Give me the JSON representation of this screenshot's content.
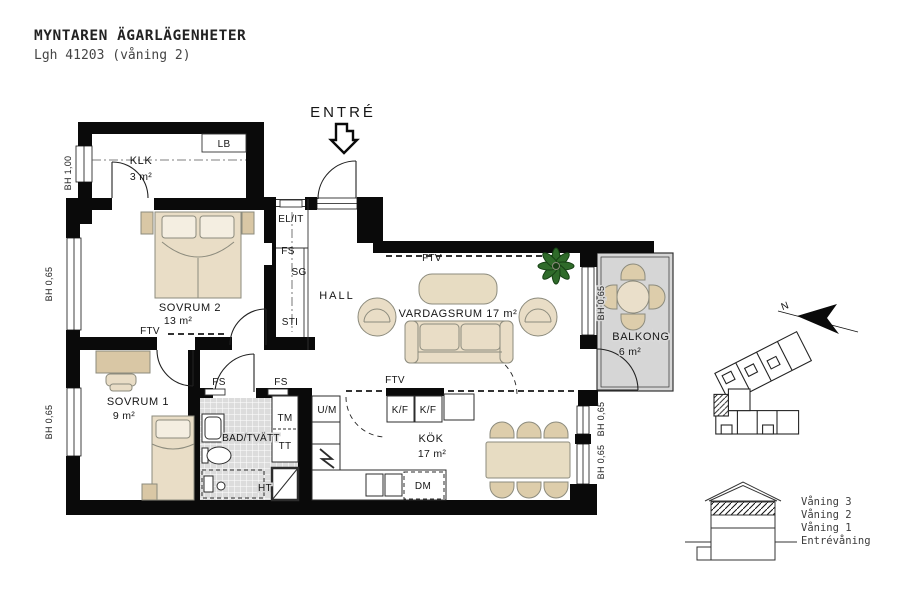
{
  "header": {
    "title": "MYNTAREN ÄGARLÄGENHETER",
    "subtitle": "Lgh 41203 (våning 2)"
  },
  "entry_label": "ENTRÉ",
  "rooms": {
    "klk": {
      "name": "KLK",
      "area": "3 m²"
    },
    "sovrum2": {
      "name": "SOVRUM 2",
      "area": "13 m²"
    },
    "sovrum1": {
      "name": "SOVRUM 1",
      "area": "9 m²"
    },
    "bad": {
      "name": "BAD/TVÄTT"
    },
    "hall": {
      "name": "HALL"
    },
    "vardagsrum": {
      "name": "VARDAGSRUM 17 m²"
    },
    "kok": {
      "name": "KÖK",
      "area": "17 m²"
    },
    "balkong": {
      "name": "BALKONG",
      "area": "6 m²"
    }
  },
  "fixtures": {
    "lb": "LB",
    "el_it": "EL/IT",
    "fs": "FS",
    "sg": "SG",
    "sti": "STI",
    "ftv": "FTV",
    "um": "U/M",
    "tm": "TM",
    "tt": "TT",
    "ht": "HT",
    "kf": "K/F",
    "dm": "DM"
  },
  "windows": {
    "bh_100": "BH 1,00",
    "bh_065": "BH 0,65"
  },
  "compass": {
    "north": "N"
  },
  "section": {
    "floors": [
      "Våning 3",
      "Våning 2",
      "Våning 1",
      "Entrévåning"
    ]
  },
  "colors": {
    "wall": "#0a0a0a",
    "furniture": "#e9ddc6",
    "furniture_dark": "#d9c7a5",
    "pillow": "#f4eee1",
    "tile": "#dcdcdc",
    "balcony": "#d6d6d6",
    "plant": "#2f6b2a"
  }
}
